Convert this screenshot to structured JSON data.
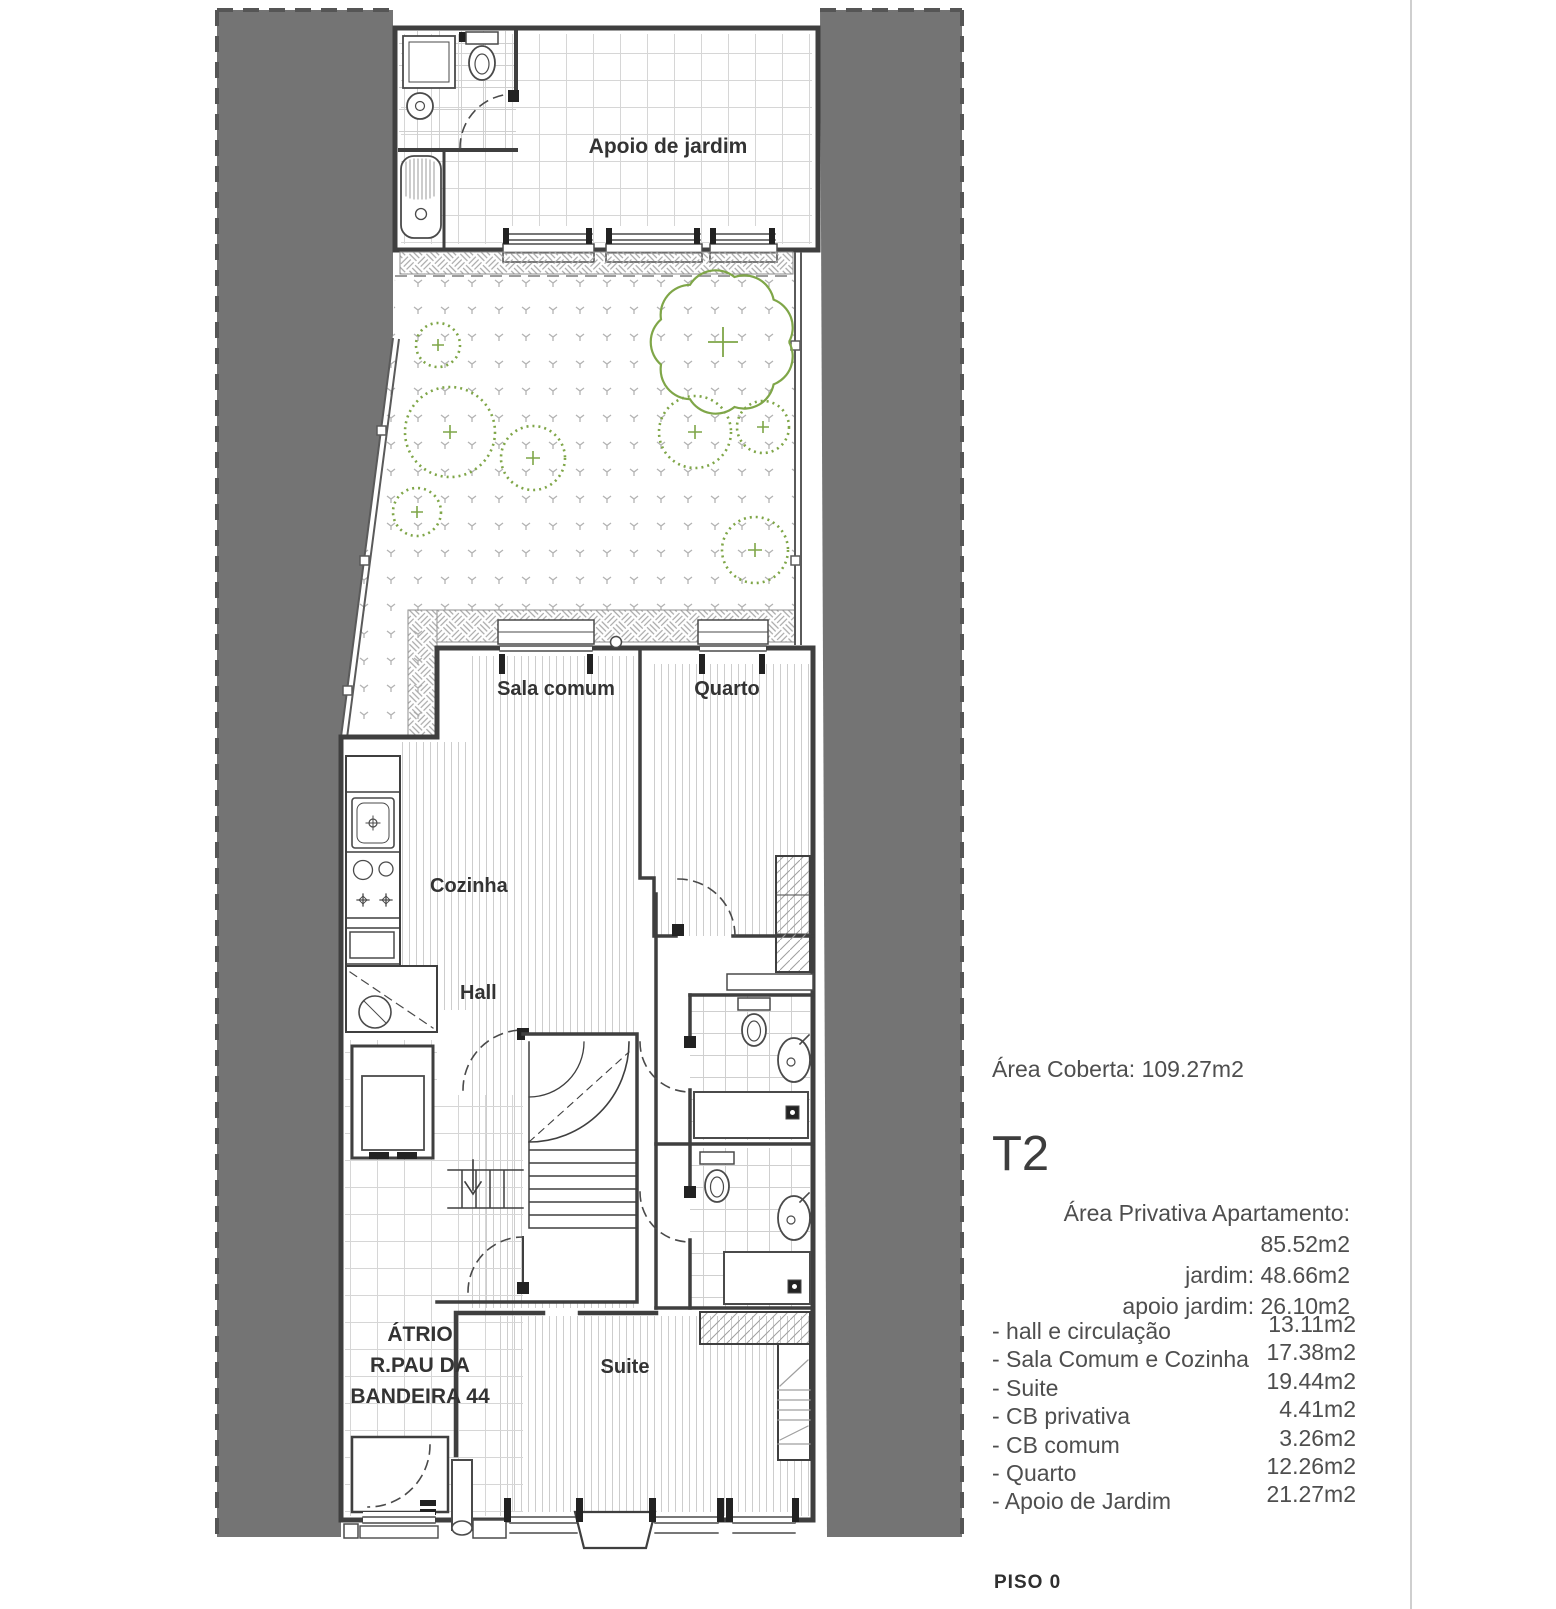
{
  "plan": {
    "labels": {
      "apoio": "Apoio de jardim",
      "sala": "Sala comum",
      "quarto": "Quarto",
      "cozinha": "Cozinha",
      "hall": "Hall",
      "atrio1": "ÁTRIO",
      "atrio2": "R.PAU DA",
      "atrio3": "BANDEIRA 44",
      "suite": "Suite"
    }
  },
  "panel": {
    "area_coberta": "Área Coberta: 109.27m2",
    "typology": "T2",
    "private_areas": [
      "Área Privativa Apartamento: 85.52m2",
      "jardim: 48.66m2",
      "apoio jardim:  26.10m2"
    ],
    "rooms": [
      {
        "label": "- hall e circulação",
        "area": "13.11m2"
      },
      {
        "label": "- Sala Comum e Cozinha",
        "area": "17.38m2"
      },
      {
        "label": "- Suite",
        "area": "19.44m2"
      },
      {
        "label": "- CB privativa",
        "area": "4.41m2"
      },
      {
        "label": "- CB comum",
        "area": "3.26m2"
      },
      {
        "label": "- Quarto",
        "area": "12.26m2"
      },
      {
        "label": "- Apoio de Jardim",
        "area": "21.27m2"
      }
    ],
    "floor": "PISO 0"
  },
  "colors": {
    "neighbor_gray": "#747474",
    "wall": "#3f3f3f",
    "vegetation": "#7fa648",
    "text": "#4e4e4e"
  }
}
